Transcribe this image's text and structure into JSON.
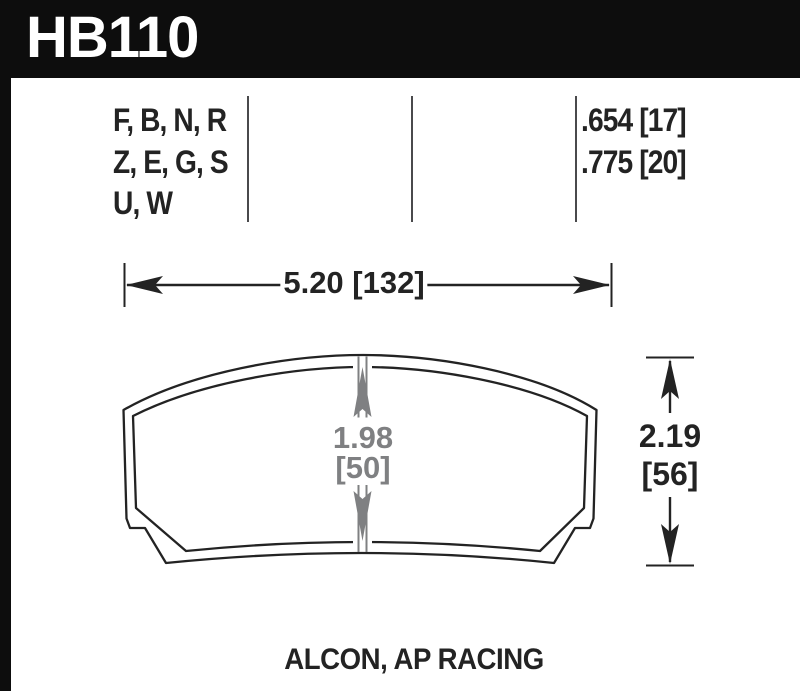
{
  "part": {
    "number": "HB110"
  },
  "specs": {
    "compounds": [
      "F, B, N, R",
      "Z, E, G, S",
      "U, W"
    ],
    "thicknesses": [
      ".654 [17]",
      ".775 [20]"
    ]
  },
  "dims": {
    "width": "5.20 [132]",
    "pad_height_in": "1.98",
    "pad_height_mm": "[50]",
    "overall_height_in": "2.19",
    "overall_height_mm": "[56]"
  },
  "caption": "ALCON, AP RACING",
  "colors": {
    "header_bg": "#0d0d0d",
    "ink": "#232323",
    "dimension_gray": "#7f8082"
  }
}
